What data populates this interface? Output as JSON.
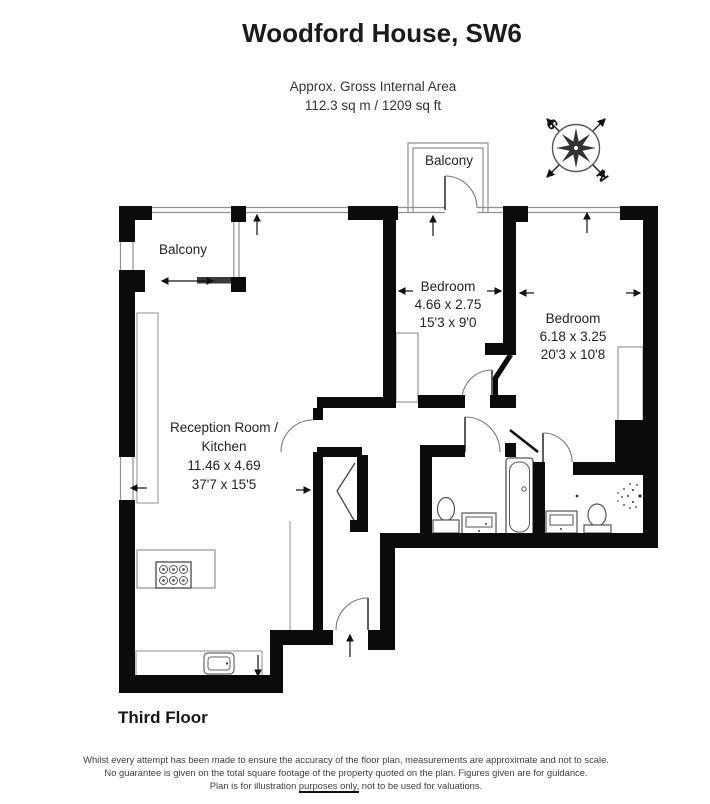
{
  "header": {
    "title": "Woodford House, SW6",
    "area_line1": "Approx. Gross Internal Area",
    "area_line2": "112.3 sq m / 1209 sq ft"
  },
  "rooms": {
    "balcony_top": "Balcony",
    "balcony_left": "Balcony",
    "bedroom1": {
      "name": "Bedroom",
      "size_metric": "4.66 x 2.75",
      "size_imperial": "15'3 x 9'0"
    },
    "bedroom2": {
      "name": "Bedroom",
      "size_metric": "6.18 x 3.25",
      "size_imperial": "20'3 x 10'8"
    },
    "reception": {
      "name_line1": "Reception Room /",
      "name_line2": "Kitchen",
      "size_metric": "11.46 x 4.69",
      "size_imperial": "37'7 x 15'5"
    }
  },
  "compass": {
    "north": "N",
    "south": "S"
  },
  "footer": {
    "floor_label": "Third Floor",
    "disclaimer_line1": "Whilst every attempt has been made to ensure the accuracy of the floor plan, measurements are approximate and not to scale.",
    "disclaimer_line2": "No guarantee is given on the total square footage of the property quoted on the plan. Figures given are for guidance.",
    "disclaimer_line3_prefix": "Plan is for illustration ",
    "disclaimer_line3_underlined": "purposes only,",
    "disclaimer_line3_suffix": " not to be used for valuations."
  },
  "colors": {
    "wall": "#0b0b0b",
    "thin_line": "#909090",
    "text": "#2c2c2c"
  }
}
